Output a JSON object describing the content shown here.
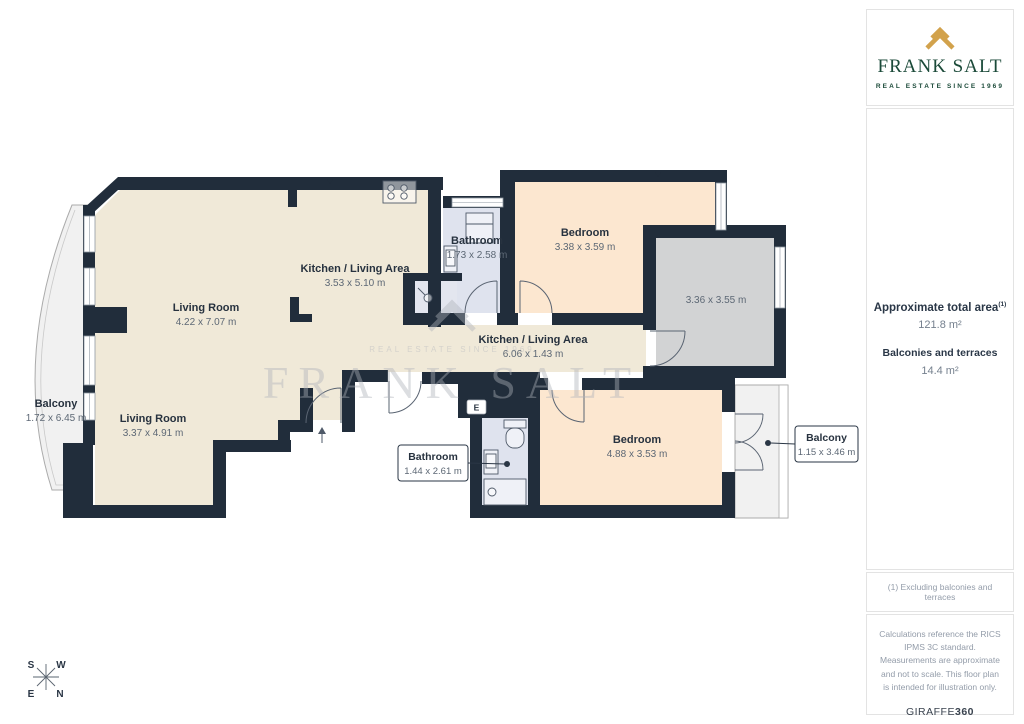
{
  "sidebar": {
    "logo": {
      "brand": "FRANK SALT",
      "tagline": "REAL ESTATE SINCE 1969",
      "chevron_color": "#D2A24C",
      "brand_color": "#1B4A39"
    },
    "area_summary": {
      "total_label": "Approximate total area",
      "total_footnote_marker": "(1)",
      "total_value": "121.8 m²",
      "balconies_label": "Balconies and terraces",
      "balconies_value": "14.4 m²"
    },
    "footnote": "(1) Excluding balconies and terraces",
    "disclaimer": "Calculations reference the RICS IPMS 3C standard. Measurements are approximate and not to scale. This floor plan is intended for illustration only.",
    "provider": {
      "name": "GIRAFFE",
      "suffix": "360"
    }
  },
  "floorplan": {
    "rooms": {
      "living_top": {
        "name": "Living Room",
        "dims": "4.22 x 7.07 m"
      },
      "kitchen_top": {
        "name": "Kitchen / Living Area",
        "dims": "3.53 x 5.10 m"
      },
      "bath_top": {
        "name": "Bathroom",
        "dims": "1.73 x 2.58 m"
      },
      "bed_top": {
        "name": "Bedroom",
        "dims": "3.38 x 3.59 m"
      },
      "store": {
        "name": "",
        "dims": "3.36 x 3.55 m"
      },
      "corridor": {
        "name": "Kitchen / Living Area",
        "dims": "6.06 x 1.43 m"
      },
      "living_bottom": {
        "name": "Living Room",
        "dims": "3.37 x 4.91 m"
      },
      "bed_bottom": {
        "name": "Bedroom",
        "dims": "4.88 x 3.53 m"
      },
      "balcony_left": {
        "name": "Balcony",
        "dims": "1.72 x 6.45 m"
      },
      "bath_bottom": {
        "name": "Bathroom",
        "dims": "1.44 x 2.61 m"
      },
      "balcony_right": {
        "name": "Balcony",
        "dims": "1.15 x 3.46 m"
      }
    },
    "entrance_label": "E",
    "compass": {
      "s": "S",
      "w": "W",
      "e": "E",
      "n": "N"
    },
    "watermark": {
      "brand": "FRANK SALT",
      "tagline": "REAL ESTATE SINCE 1969"
    },
    "colors": {
      "wall": "#212D3B",
      "floor_cream": "#F0E9D8",
      "floor_peach": "#FCE7D0",
      "floor_bath": "#DFE3EE",
      "floor_gray": "#D2D3D4",
      "balcony": "#F1F1F1"
    }
  }
}
